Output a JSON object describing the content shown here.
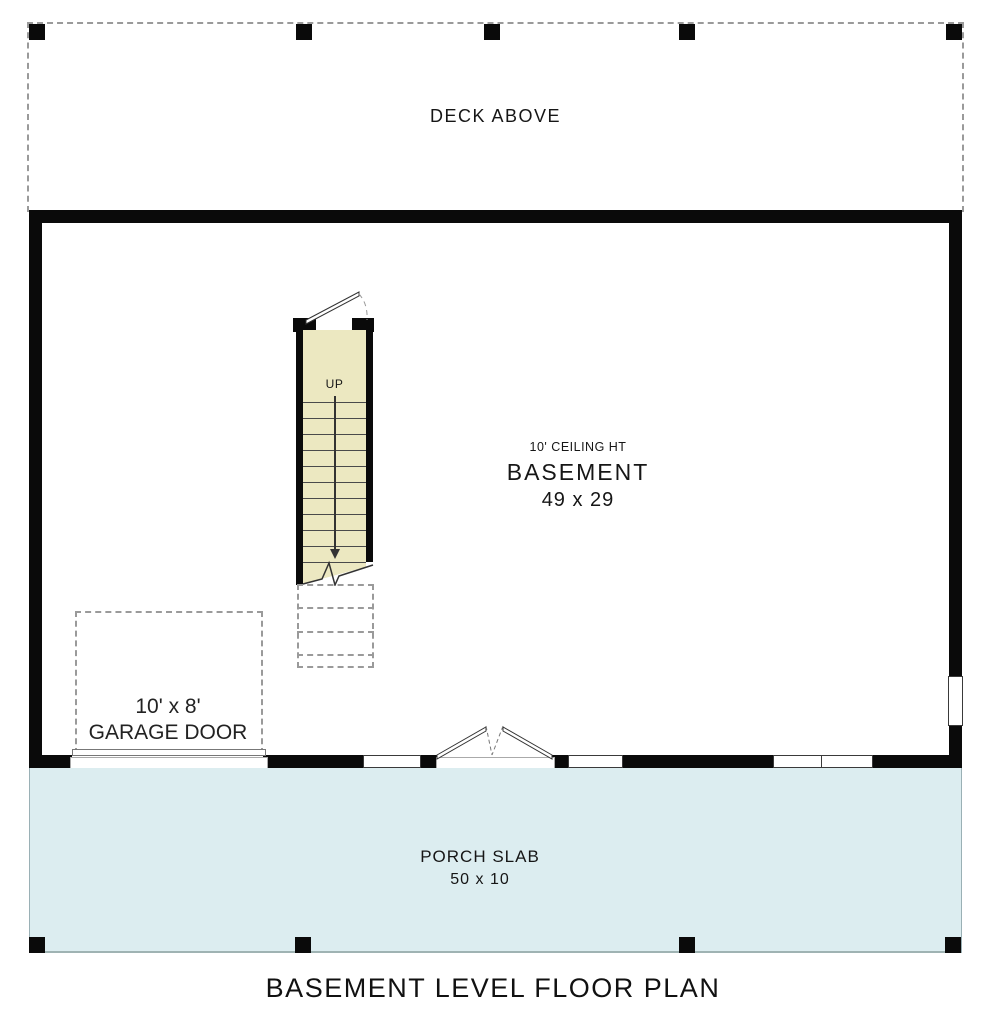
{
  "title": "BASEMENT LEVEL FLOOR PLAN",
  "deck": {
    "label": "DECK ABOVE"
  },
  "basement": {
    "ceiling_note": "10' CEILING HT",
    "name": "BASEMENT",
    "dimensions": "49 x 29"
  },
  "stairs": {
    "direction_label": "UP"
  },
  "garage_door": {
    "size": "10' x 8'",
    "label": "GARAGE DOOR"
  },
  "porch": {
    "name": "PORCH SLAB",
    "dimensions": "50 x 10"
  },
  "colors": {
    "wall": "#0a0a0a",
    "stair_fill": "#ece8c1",
    "porch_fill": "#dcedf0",
    "dash_gray": "#9a9a9a"
  }
}
